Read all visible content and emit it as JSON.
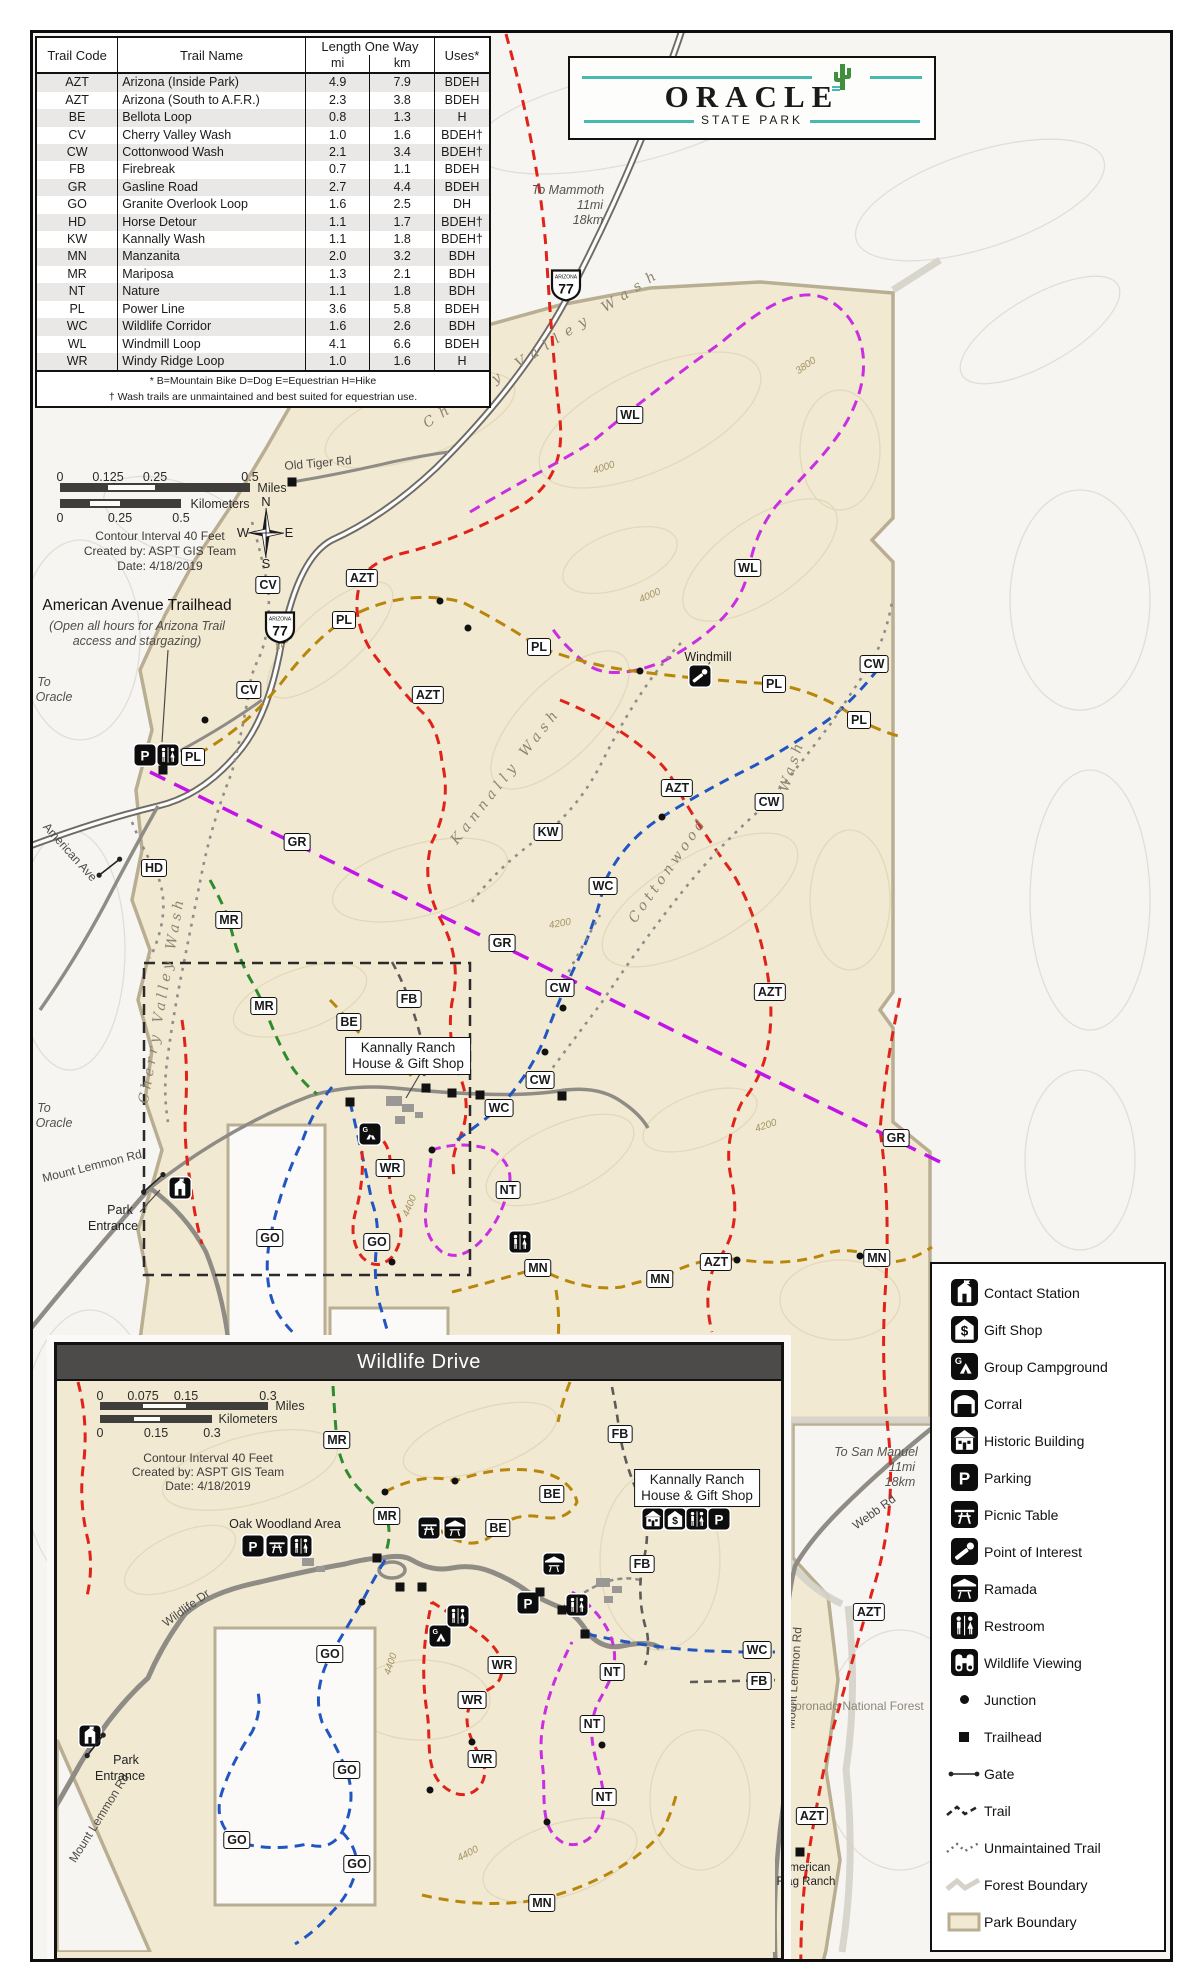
{
  "table": {
    "col_code": "Trail Code",
    "col_name": "Trail Name",
    "col_length": "Length One Way",
    "col_mi": "mi",
    "col_km": "km",
    "col_uses": "Uses*",
    "rows": [
      {
        "code": "AZT",
        "name": "Arizona (Inside Park)",
        "mi": "4.9",
        "km": "7.9",
        "uses": "BDEH"
      },
      {
        "code": "AZT",
        "name": "Arizona (South to A.F.R.)",
        "mi": "2.3",
        "km": "3.8",
        "uses": "BDEH"
      },
      {
        "code": "BE",
        "name": "Bellota Loop",
        "mi": "0.8",
        "km": "1.3",
        "uses": "H"
      },
      {
        "code": "CV",
        "name": "Cherry Valley Wash",
        "mi": "1.0",
        "km": "1.6",
        "uses": "BDEH†"
      },
      {
        "code": "CW",
        "name": "Cottonwood Wash",
        "mi": "2.1",
        "km": "3.4",
        "uses": "BDEH†"
      },
      {
        "code": "FB",
        "name": "Firebreak",
        "mi": "0.7",
        "km": "1.1",
        "uses": "BDEH"
      },
      {
        "code": "GR",
        "name": "Gasline Road",
        "mi": "2.7",
        "km": "4.4",
        "uses": "BDEH"
      },
      {
        "code": "GO",
        "name": "Granite Overlook Loop",
        "mi": "1.6",
        "km": "2.5",
        "uses": "DH"
      },
      {
        "code": "HD",
        "name": "Horse Detour",
        "mi": "1.1",
        "km": "1.7",
        "uses": "BDEH†"
      },
      {
        "code": "KW",
        "name": "Kannally Wash",
        "mi": "1.1",
        "km": "1.8",
        "uses": "BDEH†"
      },
      {
        "code": "MN",
        "name": "Manzanita",
        "mi": "2.0",
        "km": "3.2",
        "uses": "BDH"
      },
      {
        "code": "MR",
        "name": "Mariposa",
        "mi": "1.3",
        "km": "2.1",
        "uses": "BDH"
      },
      {
        "code": "NT",
        "name": "Nature",
        "mi": "1.1",
        "km": "1.8",
        "uses": "BDH"
      },
      {
        "code": "PL",
        "name": "Power Line",
        "mi": "3.6",
        "km": "5.8",
        "uses": "BDEH"
      },
      {
        "code": "WC",
        "name": "Wildlife Corridor",
        "mi": "1.6",
        "km": "2.6",
        "uses": "BDH"
      },
      {
        "code": "WL",
        "name": "Windmill Loop",
        "mi": "4.1",
        "km": "6.6",
        "uses": "BDEH"
      },
      {
        "code": "WR",
        "name": "Windy Ridge Loop",
        "mi": "1.0",
        "km": "1.6",
        "uses": "H"
      }
    ],
    "footnote1": "* B=Mountain Bike   D=Dog   E=Equestrian   H=Hike",
    "footnote2": "† Wash trails are unmaintained and best suited for equestrian use."
  },
  "logo": {
    "title": "ORACLE",
    "subtitle": "STATE PARK"
  },
  "inset_title": "Wildlife Drive",
  "compass": {
    "n": "N",
    "e": "E",
    "s": "S",
    "w": "W"
  },
  "trail_colors": {
    "AZT": "#e02318",
    "WR": "#e02318",
    "WL": "#c92fe0",
    "NT": "#c92fe0",
    "GR": "#c214e6",
    "WC": "#2156c2",
    "GO": "#2156c2",
    "PL": "#b8860b",
    "MN": "#b8860b",
    "BE": "#b8860b",
    "MR": "#2e8b2e",
    "CV": "#8f8d88",
    "CW": "#8f8d88",
    "KW": "#8f8d88",
    "HD": "#8f8d88",
    "FB": "#5c5b58"
  },
  "scalebars": [
    {
      "ticks_top": [
        {
          "t": "0",
          "x": 60
        },
        {
          "t": "0.125",
          "x": 108
        },
        {
          "t": "0.25",
          "x": 155
        },
        {
          "t": "0.5",
          "x": 250
        }
      ],
      "ticks_top_y": 477,
      "bar": {
        "x1": 60,
        "x2": 250,
        "y": 483,
        "h": 9,
        "w1": 108,
        "w2": 155
      },
      "unit_top": {
        "t": "Miles",
        "x": 272,
        "y": 488
      },
      "bar2": {
        "x1": 60,
        "x2": 181,
        "y": 499,
        "h": 9,
        "w1": 90,
        "w2": 120
      },
      "unit_bot": {
        "t": "Kilometers",
        "x": 220,
        "y": 504
      },
      "ticks_bot": [
        {
          "t": "0",
          "x": 60
        },
        {
          "t": "0.25",
          "x": 120
        },
        {
          "t": "0.5",
          "x": 181
        }
      ],
      "ticks_bot_y": 518
    },
    {
      "ticks_top": [
        {
          "t": "0",
          "x": 100
        },
        {
          "t": "0.075",
          "x": 143
        },
        {
          "t": "0.15",
          "x": 186
        },
        {
          "t": "0.3",
          "x": 268
        }
      ],
      "ticks_top_y": 1396,
      "bar": {
        "x1": 100,
        "x2": 268,
        "y": 1402,
        "h": 8,
        "w1": 143,
        "w2": 186
      },
      "unit_top": {
        "t": "Miles",
        "x": 290,
        "y": 1406
      },
      "bar2": {
        "x1": 100,
        "x2": 212,
        "y": 1415,
        "h": 8,
        "w1": 134,
        "w2": 160
      },
      "unit_bot": {
        "t": "Kilometers",
        "x": 248,
        "y": 1419
      },
      "ticks_bot": [
        {
          "t": "0",
          "x": 100
        },
        {
          "t": "0.15",
          "x": 156
        },
        {
          "t": "0.3",
          "x": 212
        }
      ],
      "ticks_bot_y": 1433
    }
  ],
  "labels": [
    {
      "t": "Contour Interval 40 Feet",
      "x": 160,
      "y": 536,
      "c": "credit"
    },
    {
      "t": "Created by: ASPT GIS Team",
      "x": 160,
      "y": 551,
      "c": "credit"
    },
    {
      "t": "Date: 4/18/2019",
      "x": 160,
      "y": 566,
      "c": "credit"
    },
    {
      "t": "Old Tiger Rd",
      "x": 318,
      "y": 463,
      "r": -5,
      "c": "road"
    },
    {
      "t": "To Mammoth",
      "x": 568,
      "y": 190,
      "c": "dest-i"
    },
    {
      "t": "11mi",
      "x": 590,
      "y": 205,
      "c": "dest-i"
    },
    {
      "t": "18km",
      "x": 588,
      "y": 220,
      "c": "dest-i"
    },
    {
      "t": "Cherry Valley Wash",
      "x": 543,
      "y": 348,
      "r": -33,
      "c": "wash ls8"
    },
    {
      "t": "Cherry Valley Wash",
      "x": 162,
      "y": 1000,
      "r": -80,
      "c": "wash ls4"
    },
    {
      "t": "Kannally Wash",
      "x": 506,
      "y": 776,
      "r": -52,
      "c": "wash ls5"
    },
    {
      "t": "Cottonwood",
      "x": 668,
      "y": 870,
      "r": -55,
      "c": "wash ls4"
    },
    {
      "t": "Wash",
      "x": 792,
      "y": 766,
      "r": -72,
      "c": "wash ls4"
    },
    {
      "t": "Windmill",
      "x": 708,
      "y": 657,
      "c": "place"
    },
    {
      "t": "American Avenue Trailhead",
      "x": 137,
      "y": 606,
      "c": "ann-title"
    },
    {
      "t": "(Open all hours for Arizona Trail",
      "x": 137,
      "y": 626,
      "c": "ann-i"
    },
    {
      "t": "access and stargazing)",
      "x": 137,
      "y": 641,
      "c": "ann-i"
    },
    {
      "t": "To",
      "x": 44,
      "y": 682,
      "c": "dest-i"
    },
    {
      "t": "Oracle",
      "x": 54,
      "y": 697,
      "c": "dest-i"
    },
    {
      "t": "To",
      "x": 44,
      "y": 1108,
      "c": "dest-i"
    },
    {
      "t": "Oracle",
      "x": 54,
      "y": 1123,
      "c": "dest-i"
    },
    {
      "t": "American Ave",
      "x": 70,
      "y": 852,
      "r": 48,
      "c": "road"
    },
    {
      "t": "Mount Lemmon Rd",
      "x": 92,
      "y": 1166,
      "r": -14,
      "c": "road"
    },
    {
      "t": "Park",
      "x": 120,
      "y": 1210,
      "c": "place"
    },
    {
      "t": "Entrance",
      "x": 113,
      "y": 1226,
      "c": "place"
    },
    {
      "t": "4200",
      "x": 284,
      "y": 642,
      "r": -42,
      "c": "cont"
    },
    {
      "t": "4000",
      "x": 650,
      "y": 596,
      "r": -24,
      "c": "cont"
    },
    {
      "t": "4000",
      "x": 604,
      "y": 468,
      "r": -18,
      "c": "cont"
    },
    {
      "t": "3800",
      "x": 806,
      "y": 366,
      "r": -35,
      "c": "cont"
    },
    {
      "t": "4200",
      "x": 560,
      "y": 924,
      "r": -10,
      "c": "cont"
    },
    {
      "t": "4200",
      "x": 766,
      "y": 1126,
      "r": -18,
      "c": "cont"
    },
    {
      "t": "4400",
      "x": 410,
      "y": 1206,
      "r": -68,
      "c": "cont"
    },
    {
      "t": "Coronado National Forest",
      "x": 855,
      "y": 1706,
      "c": "forest"
    },
    {
      "t": "To San Manuel",
      "x": 876,
      "y": 1452,
      "c": "dest-i"
    },
    {
      "t": "11mi",
      "x": 902,
      "y": 1467,
      "c": "dest-i"
    },
    {
      "t": "18km",
      "x": 900,
      "y": 1482,
      "c": "dest-i"
    },
    {
      "t": "Webb Rd",
      "x": 874,
      "y": 1512,
      "r": -36,
      "c": "road"
    },
    {
      "t": "Mount Lemmon Rd",
      "x": 794,
      "y": 1678,
      "r": -86,
      "c": "road"
    },
    {
      "t": "American",
      "x": 806,
      "y": 1868,
      "c": "place-s"
    },
    {
      "t": "Flag Ranch",
      "x": 806,
      "y": 1882,
      "c": "place-s"
    },
    {
      "t": "Contour Interval 40 Feet",
      "x": 208,
      "y": 1458,
      "c": "credit"
    },
    {
      "t": "Created by: ASPT GIS Team",
      "x": 208,
      "y": 1472,
      "c": "credit"
    },
    {
      "t": "Date: 4/18/2019",
      "x": 208,
      "y": 1486,
      "c": "credit"
    },
    {
      "t": "Oak Woodland Area",
      "x": 285,
      "y": 1524,
      "c": "place"
    },
    {
      "t": "Wildlife Dr",
      "x": 186,
      "y": 1608,
      "r": -36,
      "c": "road"
    },
    {
      "t": "Mount Lemmon Rd",
      "x": 99,
      "y": 1818,
      "r": -58,
      "c": "road"
    },
    {
      "t": "Park",
      "x": 126,
      "y": 1760,
      "c": "place"
    },
    {
      "t": "Entrance",
      "x": 120,
      "y": 1776,
      "c": "place"
    },
    {
      "t": "4400",
      "x": 391,
      "y": 1664,
      "r": -72,
      "c": "cont"
    },
    {
      "t": "4400",
      "x": 468,
      "y": 1854,
      "r": -28,
      "c": "cont"
    }
  ],
  "boxed_labels": [
    {
      "l1": "Kannally Ranch",
      "l2": "House & Gift Shop",
      "x": 408,
      "y": 1056
    },
    {
      "l1": "Kannally Ranch",
      "l2": "House & Gift Shop",
      "x": 697,
      "y": 1488
    }
  ],
  "badges": [
    {
      "code": "WL",
      "x": 630,
      "y": 415
    },
    {
      "code": "WL",
      "x": 748,
      "y": 568
    },
    {
      "code": "CV",
      "x": 268,
      "y": 585
    },
    {
      "code": "CV",
      "x": 249,
      "y": 690
    },
    {
      "code": "AZT",
      "x": 362,
      "y": 578
    },
    {
      "code": "AZT",
      "x": 428,
      "y": 695
    },
    {
      "code": "AZT",
      "x": 677,
      "y": 788
    },
    {
      "code": "AZT",
      "x": 770,
      "y": 992
    },
    {
      "code": "AZT",
      "x": 716,
      "y": 1262
    },
    {
      "code": "AZT",
      "x": 869,
      "y": 1612
    },
    {
      "code": "AZT",
      "x": 812,
      "y": 1816
    },
    {
      "code": "PL",
      "x": 193,
      "y": 757
    },
    {
      "code": "PL",
      "x": 344,
      "y": 620
    },
    {
      "code": "PL",
      "x": 539,
      "y": 647
    },
    {
      "code": "PL",
      "x": 774,
      "y": 684
    },
    {
      "code": "PL",
      "x": 859,
      "y": 720
    },
    {
      "code": "CW",
      "x": 874,
      "y": 664
    },
    {
      "code": "CW",
      "x": 769,
      "y": 802
    },
    {
      "code": "CW",
      "x": 560,
      "y": 988
    },
    {
      "code": "CW",
      "x": 540,
      "y": 1080
    },
    {
      "code": "KW",
      "x": 548,
      "y": 832
    },
    {
      "code": "WC",
      "x": 603,
      "y": 886
    },
    {
      "code": "WC",
      "x": 499,
      "y": 1108
    },
    {
      "code": "HD",
      "x": 154,
      "y": 868
    },
    {
      "code": "MR",
      "x": 229,
      "y": 920
    },
    {
      "code": "MR",
      "x": 264,
      "y": 1006
    },
    {
      "code": "GR",
      "x": 297,
      "y": 842
    },
    {
      "code": "GR",
      "x": 502,
      "y": 943
    },
    {
      "code": "GR",
      "x": 896,
      "y": 1138
    },
    {
      "code": "FB",
      "x": 409,
      "y": 999
    },
    {
      "code": "BE",
      "x": 349,
      "y": 1022
    },
    {
      "code": "WR",
      "x": 390,
      "y": 1168
    },
    {
      "code": "NT",
      "x": 508,
      "y": 1190
    },
    {
      "code": "GO",
      "x": 270,
      "y": 1238
    },
    {
      "code": "GO",
      "x": 377,
      "y": 1242
    },
    {
      "code": "MN",
      "x": 538,
      "y": 1268
    },
    {
      "code": "MN",
      "x": 660,
      "y": 1279
    },
    {
      "code": "MN",
      "x": 877,
      "y": 1258
    },
    {
      "code": "MR",
      "x": 337,
      "y": 1440
    },
    {
      "code": "MR",
      "x": 387,
      "y": 1516
    },
    {
      "code": "BE",
      "x": 552,
      "y": 1494
    },
    {
      "code": "BE",
      "x": 498,
      "y": 1528
    },
    {
      "code": "FB",
      "x": 620,
      "y": 1434
    },
    {
      "code": "FB",
      "x": 642,
      "y": 1564
    },
    {
      "code": "WC",
      "x": 757,
      "y": 1650
    },
    {
      "code": "FB",
      "x": 759,
      "y": 1681
    },
    {
      "code": "GO",
      "x": 330,
      "y": 1654
    },
    {
      "code": "GO",
      "x": 347,
      "y": 1770
    },
    {
      "code": "GO",
      "x": 237,
      "y": 1840
    },
    {
      "code": "GO",
      "x": 357,
      "y": 1864
    },
    {
      "code": "WR",
      "x": 502,
      "y": 1665
    },
    {
      "code": "WR",
      "x": 472,
      "y": 1700
    },
    {
      "code": "WR",
      "x": 482,
      "y": 1759
    },
    {
      "code": "NT",
      "x": 612,
      "y": 1672
    },
    {
      "code": "NT",
      "x": 592,
      "y": 1724
    },
    {
      "code": "NT",
      "x": 604,
      "y": 1797
    },
    {
      "code": "MN",
      "x": 542,
      "y": 1903
    }
  ],
  "map_icons": [
    {
      "type": "parking",
      "x": 145,
      "y": 755
    },
    {
      "type": "restroom",
      "x": 168,
      "y": 755
    },
    {
      "type": "poi",
      "x": 700,
      "y": 676
    },
    {
      "type": "campground",
      "x": 370,
      "y": 1134
    },
    {
      "type": "restroom",
      "x": 520,
      "y": 1242
    },
    {
      "type": "contact",
      "x": 180,
      "y": 1188
    },
    {
      "type": "parking",
      "x": 253,
      "y": 1546
    },
    {
      "type": "picnic",
      "x": 277,
      "y": 1546
    },
    {
      "type": "restroom",
      "x": 301,
      "y": 1546
    },
    {
      "type": "picnic",
      "x": 429,
      "y": 1528
    },
    {
      "type": "ramada",
      "x": 455,
      "y": 1528
    },
    {
      "type": "ramada",
      "x": 554,
      "y": 1564
    },
    {
      "type": "campground",
      "x": 440,
      "y": 1636
    },
    {
      "type": "restroom",
      "x": 458,
      "y": 1616
    },
    {
      "type": "parking",
      "x": 528,
      "y": 1603
    },
    {
      "type": "restroom",
      "x": 577,
      "y": 1605
    },
    {
      "type": "historic",
      "x": 653,
      "y": 1519
    },
    {
      "type": "giftshop",
      "x": 675,
      "y": 1519
    },
    {
      "type": "restroom",
      "x": 697,
      "y": 1519
    },
    {
      "type": "parking",
      "x": 719,
      "y": 1519
    },
    {
      "type": "contact",
      "x": 90,
      "y": 1736
    }
  ],
  "junction_dots": [
    {
      "x": 440,
      "y": 601
    },
    {
      "x": 468,
      "y": 628
    },
    {
      "x": 537,
      "y": 650
    },
    {
      "x": 640,
      "y": 671
    },
    {
      "x": 283,
      "y": 640
    },
    {
      "x": 602,
      "y": 886
    },
    {
      "x": 662,
      "y": 817
    },
    {
      "x": 545,
      "y": 1052
    },
    {
      "x": 563,
      "y": 1008
    },
    {
      "x": 205,
      "y": 720
    },
    {
      "x": 372,
      "y": 1132
    },
    {
      "x": 432,
      "y": 1150
    },
    {
      "x": 392,
      "y": 1262
    },
    {
      "x": 737,
      "y": 1260
    },
    {
      "x": 860,
      "y": 1256
    },
    {
      "x": 385,
      "y": 1492
    },
    {
      "x": 455,
      "y": 1481
    },
    {
      "x": 477,
      "y": 1702
    },
    {
      "x": 472,
      "y": 1742
    },
    {
      "x": 547,
      "y": 1822
    },
    {
      "x": 602,
      "y": 1745
    },
    {
      "x": 362,
      "y": 1602
    },
    {
      "x": 430,
      "y": 1790
    }
  ],
  "trailhead_squares": [
    {
      "x": 292,
      "y": 482
    },
    {
      "x": 163,
      "y": 770
    },
    {
      "x": 350,
      "y": 1102
    },
    {
      "x": 426,
      "y": 1088
    },
    {
      "x": 452,
      "y": 1093
    },
    {
      "x": 562,
      "y": 1096
    },
    {
      "x": 480,
      "y": 1095
    },
    {
      "x": 800,
      "y": 1852
    },
    {
      "x": 377,
      "y": 1558
    },
    {
      "x": 400,
      "y": 1587
    },
    {
      "x": 422,
      "y": 1587
    },
    {
      "x": 540,
      "y": 1592
    },
    {
      "x": 562,
      "y": 1610
    },
    {
      "x": 585,
      "y": 1634
    }
  ],
  "gates": [
    {
      "x": 110,
      "y": 868,
      "r": -38
    },
    {
      "x": 154,
      "y": 1184,
      "r": -42
    },
    {
      "x": 96,
      "y": 1746,
      "r": -52
    }
  ],
  "shields": [
    {
      "state": "ARIZONA",
      "num": "77",
      "x": 566,
      "y": 288
    },
    {
      "state": "ARIZONA",
      "num": "77",
      "x": 280,
      "y": 630
    }
  ],
  "legend": {
    "items": [
      {
        "icon": "contact",
        "label": "Contact Station"
      },
      {
        "icon": "giftshop",
        "label": "Gift Shop"
      },
      {
        "icon": "campground",
        "label": "Group Campground"
      },
      {
        "icon": "corral",
        "label": "Corral"
      },
      {
        "icon": "historic",
        "label": "Historic Building"
      },
      {
        "icon": "parking",
        "label": "Parking"
      },
      {
        "icon": "picnic",
        "label": "Picnic Table"
      },
      {
        "icon": "poi",
        "label": "Point of Interest"
      },
      {
        "icon": "ramada",
        "label": "Ramada"
      },
      {
        "icon": "restroom",
        "label": "Restroom"
      },
      {
        "icon": "wildlife",
        "label": "Wildlife Viewing"
      },
      {
        "icon": "junction",
        "label": "Junction"
      },
      {
        "icon": "trailhead",
        "label": "Trailhead"
      },
      {
        "icon": "gate",
        "label": "Gate"
      },
      {
        "icon": "trail",
        "label": "Trail"
      },
      {
        "icon": "unmaintained",
        "label": "Unmaintained Trail"
      },
      {
        "icon": "forestline",
        "label": "Forest Boundary"
      },
      {
        "icon": "parkfill",
        "label": "Park Boundary"
      }
    ]
  },
  "colors": {
    "park_fill": "#f2e9d3",
    "park_border": "#b9ae92",
    "road": "#8f8c86",
    "highway_casing": "#6e6b66"
  }
}
